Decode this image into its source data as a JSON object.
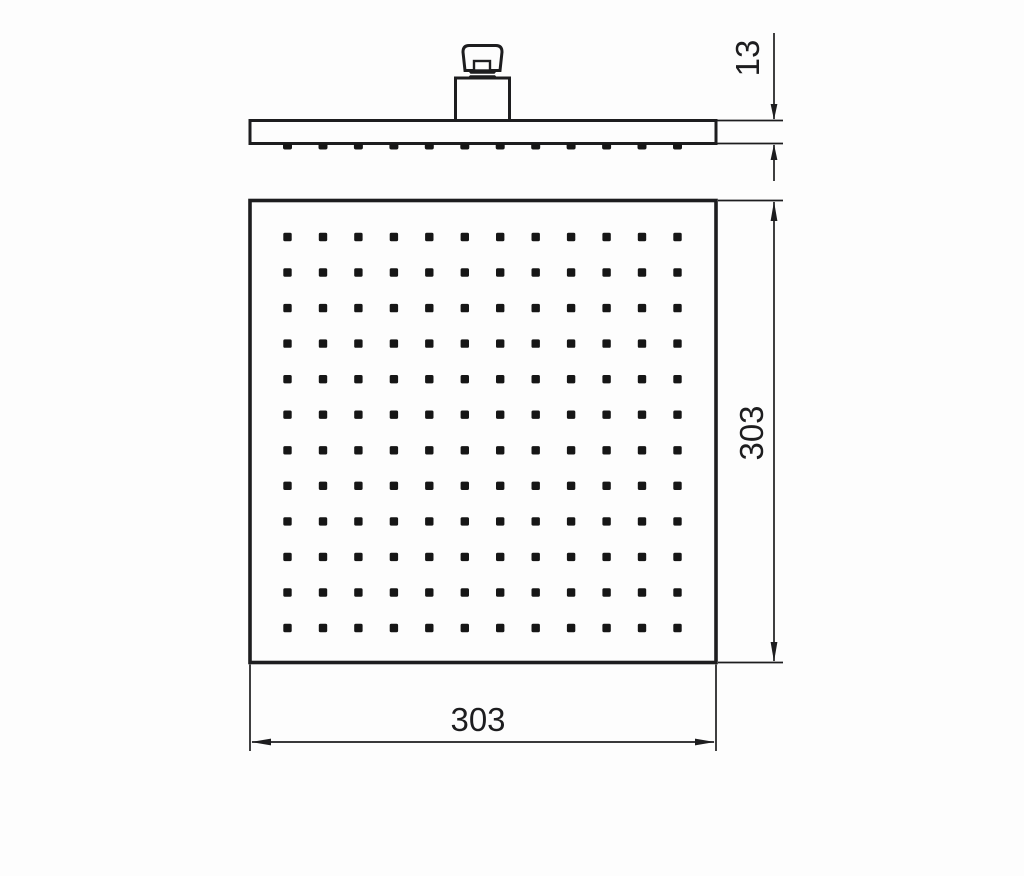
{
  "drawing": {
    "kind": "technical-dimension-drawing",
    "views": {
      "side": {
        "name": "side-profile",
        "nozzle_count": 12
      },
      "face": {
        "name": "spray-face",
        "rows": 12,
        "columns": 12
      }
    }
  },
  "dimensions": {
    "plate_thickness": {
      "label": "13"
    },
    "face_height": {
      "label": "303"
    },
    "face_width": {
      "label": "303"
    }
  },
  "colors": {
    "line": "#1d1d1f",
    "background": "#fdfdfd",
    "nozzle": "#161616"
  }
}
